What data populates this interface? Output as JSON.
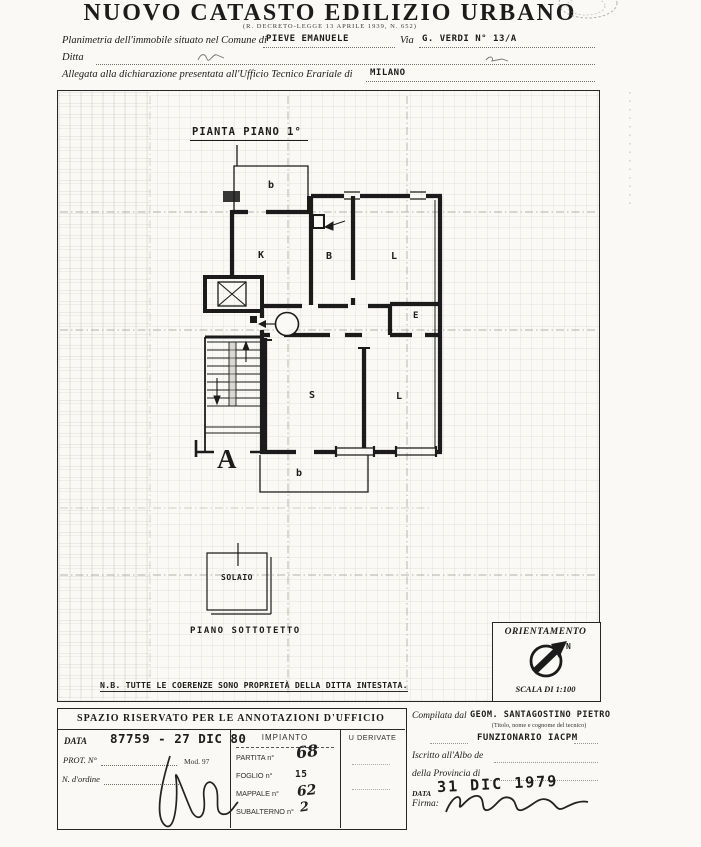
{
  "header": {
    "title": "NUOVO CATASTO EDILIZIO URBANO",
    "law_note": "(R. DECRETO-LEGGE 13 APRILE 1939, N. 652)"
  },
  "form": {
    "comune_label": "Planimetria dell'immobile situato nel Comune di",
    "comune_value": "PIEVE EMANUELE",
    "via_label": "Via",
    "via_value": "G. VERDI N° 13/A",
    "ditta_label": "Ditta",
    "ufficio_label": "Allegata alla dichiarazione presentata all'Ufficio Tecnico Erariale di",
    "ufficio_value": "MILANO"
  },
  "plan": {
    "title": "PIANTA PIANO 1°",
    "unit_number": "1",
    "rooms": {
      "balcony_top": "b",
      "kitchen": "K",
      "bathroom": "B",
      "living_top": "L",
      "closet": "E",
      "bedroom": "S",
      "living_bottom": "L",
      "stairwell": "A",
      "balcony_bottom": "b"
    },
    "solaio_label": "SOLAIO",
    "sottotetto_label": "PIANO  SOTTOTETTO",
    "note": "N.B. TUTTE LE COERENZE SONO PROPRIETÀ DELLA DITTA INTESTATA.",
    "orientation": {
      "title": "ORIENTAMENTO",
      "north_label": "N",
      "scale_label": "SCALA DI 1:100"
    }
  },
  "office_box": {
    "header": "SPAZIO RISERVATO PER LE ANNOTAZIONI D'UFFICIO",
    "data_label": "DATA",
    "protocol_stamp": "87759 - 27 DIC 80",
    "prot_label": "PROT. N°",
    "mod_label": "Mod. 97",
    "ordine_label": "N. d'ordine",
    "impianto_header": "IMPIANTO",
    "derivate_header": "U DERIVATE",
    "partita_label": "PARTITA n°",
    "partita_value": "68",
    "foglio_label": "FOGLIO n°",
    "foglio_value": "15",
    "mappale_label": "MAPPALE n°",
    "mappale_value": "62",
    "subalterno_label": "SUBALTERNO n°",
    "subalterno_value": "2"
  },
  "compiler": {
    "compilata_label": "Compilata dal",
    "name": "GEOM. SANTAGOSTINO PIETRO",
    "name_note": "(Titolo, nome e cognome del tecnico)",
    "role": "FUNZIONARIO IACPM",
    "albo_label": "Iscritto all'Albo de",
    "provincia_label": "della Provincia di",
    "data_label": "DATA",
    "date_stamp": "31 DIC 1979",
    "firma_label": "Firma:"
  },
  "colors": {
    "ink": "#1c1c1c",
    "paper": "#faf9f5",
    "faint": "#8d8d85"
  }
}
